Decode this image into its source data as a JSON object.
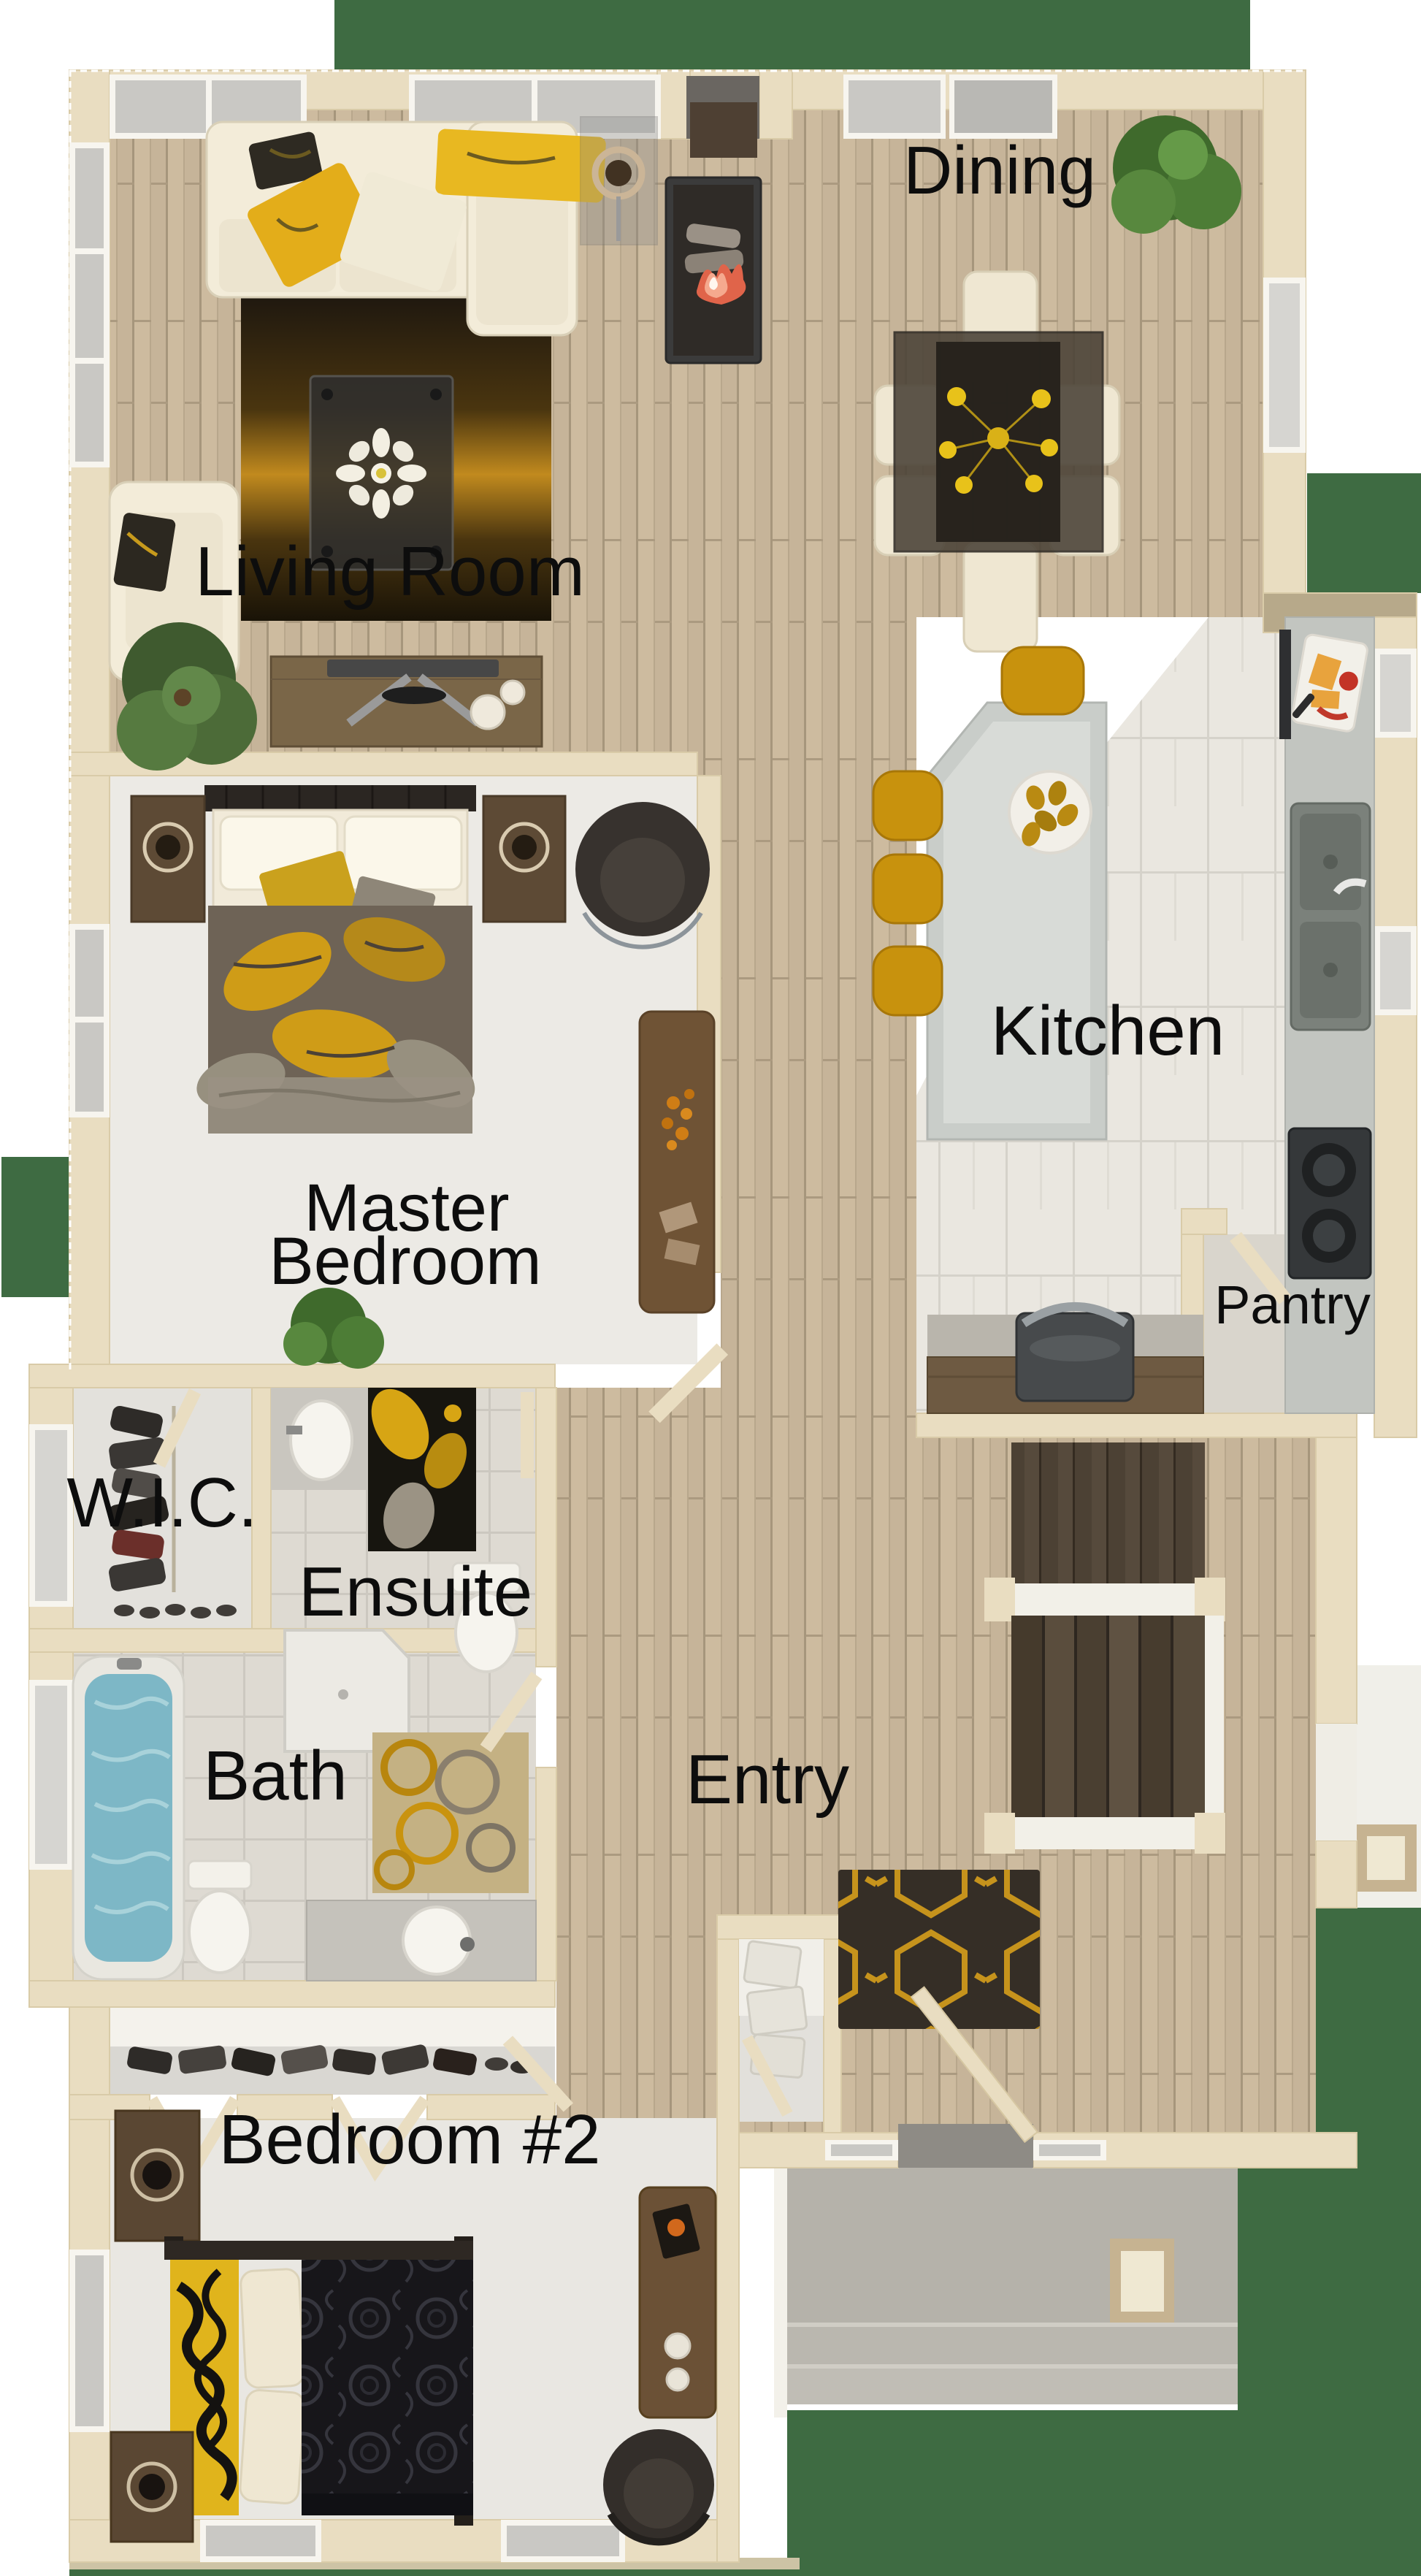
{
  "title": "Floor plan",
  "rooms": {
    "dining": {
      "label": "Dining"
    },
    "living": {
      "label": "Living Room"
    },
    "kitchen": {
      "label": "Kitchen"
    },
    "master": {
      "label_line1": "Master",
      "label_line2": "Bedroom"
    },
    "pantry": {
      "label": "Pantry"
    },
    "wic": {
      "label": "W.I.C."
    },
    "ensuite": {
      "label": "Ensuite"
    },
    "bath": {
      "label": "Bath"
    },
    "entry": {
      "label": "Entry"
    },
    "bedroom2": {
      "label": "Bedroom #2"
    }
  },
  "palette": {
    "wall_cream": "#e9ddc1",
    "wall_trim": "#f6efdd",
    "wood_floor": "#c2ae92",
    "kitchen_tile": "#eae7e0",
    "carpet": "#e9e7e2",
    "bath_tile": "#dedad2",
    "concrete_porch": "#b5b2aa",
    "grass_green": "#3e6b42",
    "accent_gold": "#c8930f",
    "rug_dark": "#352e26",
    "water_blue": "#7db7c6",
    "label_color": "#0d0d0d"
  }
}
